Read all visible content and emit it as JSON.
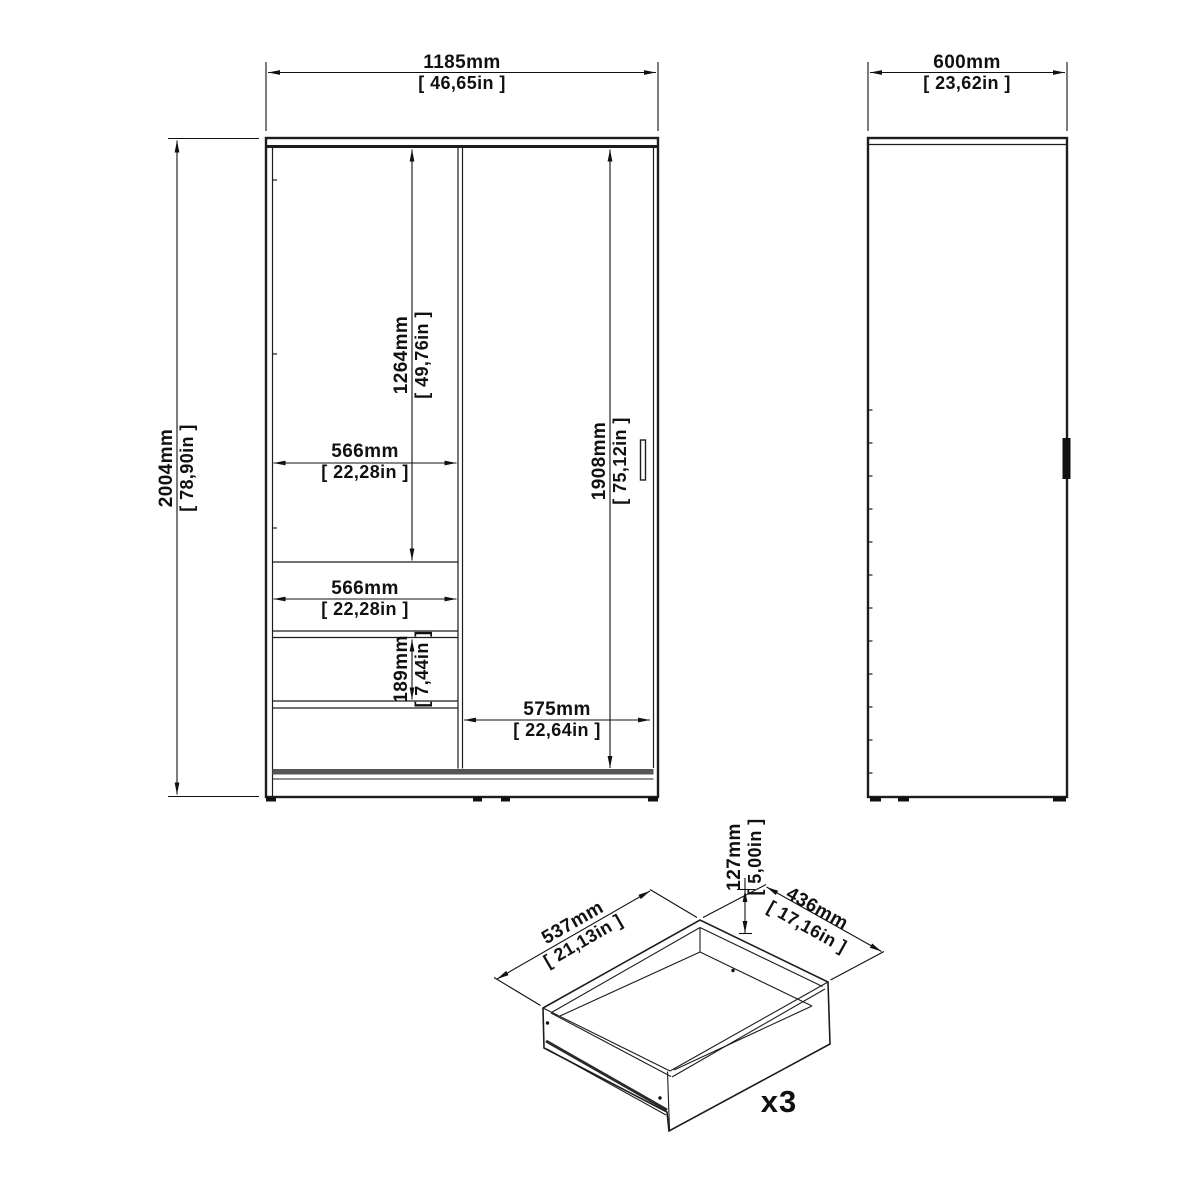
{
  "front_view": {
    "overall_width": {
      "mm": "1185mm",
      "inches": "[ 46,65in ]"
    },
    "overall_height": {
      "mm": "2004mm",
      "inches": "[ 78,90in ]"
    },
    "opening_height": {
      "mm": "1264mm",
      "inches": "[ 49,76in ]"
    },
    "opening_width": {
      "mm": "566mm",
      "inches": "[ 22,28in ]"
    },
    "drawer_width": {
      "mm": "566mm",
      "inches": "[ 22,28in ]"
    },
    "drawer_height": {
      "mm": "189mm",
      "inches": "[ 7,44in ]"
    },
    "door_height": {
      "mm": "1908mm",
      "inches": "[ 75,12in ]"
    },
    "door_width": {
      "mm": "575mm",
      "inches": "[ 22,64in ]"
    }
  },
  "side_view": {
    "depth": {
      "mm": "600mm",
      "inches": "[ 23,62in ]"
    }
  },
  "drawer_detail": {
    "width": {
      "mm": "537mm",
      "inches": "[ 21,13in ]"
    },
    "height": {
      "mm": "127mm",
      "inches": "[ 5,00in ]"
    },
    "depth": {
      "mm": "436mm",
      "inches": "[ 17,16in ]"
    },
    "quantity": "x3"
  },
  "colors": {
    "line": "#1d1d1d",
    "bottom_rail": "#555555",
    "handle_fill": "#111111"
  }
}
